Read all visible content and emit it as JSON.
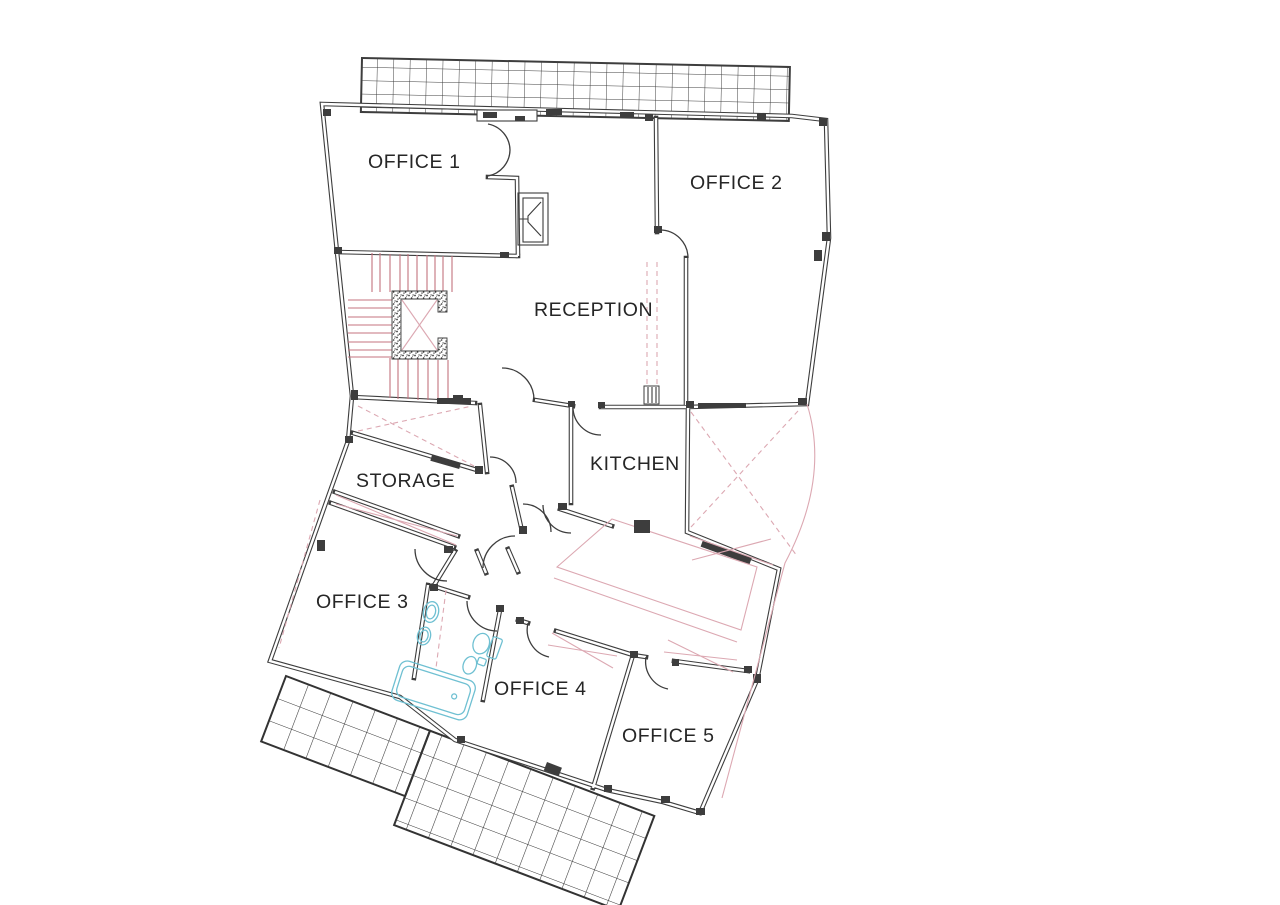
{
  "labels": {
    "office1": "OFFICE 1",
    "office2": "OFFICE 2",
    "reception": "RECEPTION",
    "kitchen": "KITCHEN",
    "storage": "STORAGE",
    "office3": "OFFICE 3",
    "office4": "OFFICE 4",
    "office5": "OFFICE 5"
  },
  "colors": {
    "wall": "#3d3d3d",
    "accent_pink": "#c4737f",
    "accent_pink_light": "#dca8b2",
    "fixture_cyan": "#6fc0d2",
    "label_text": "#262626",
    "paper": "#ffffff"
  }
}
